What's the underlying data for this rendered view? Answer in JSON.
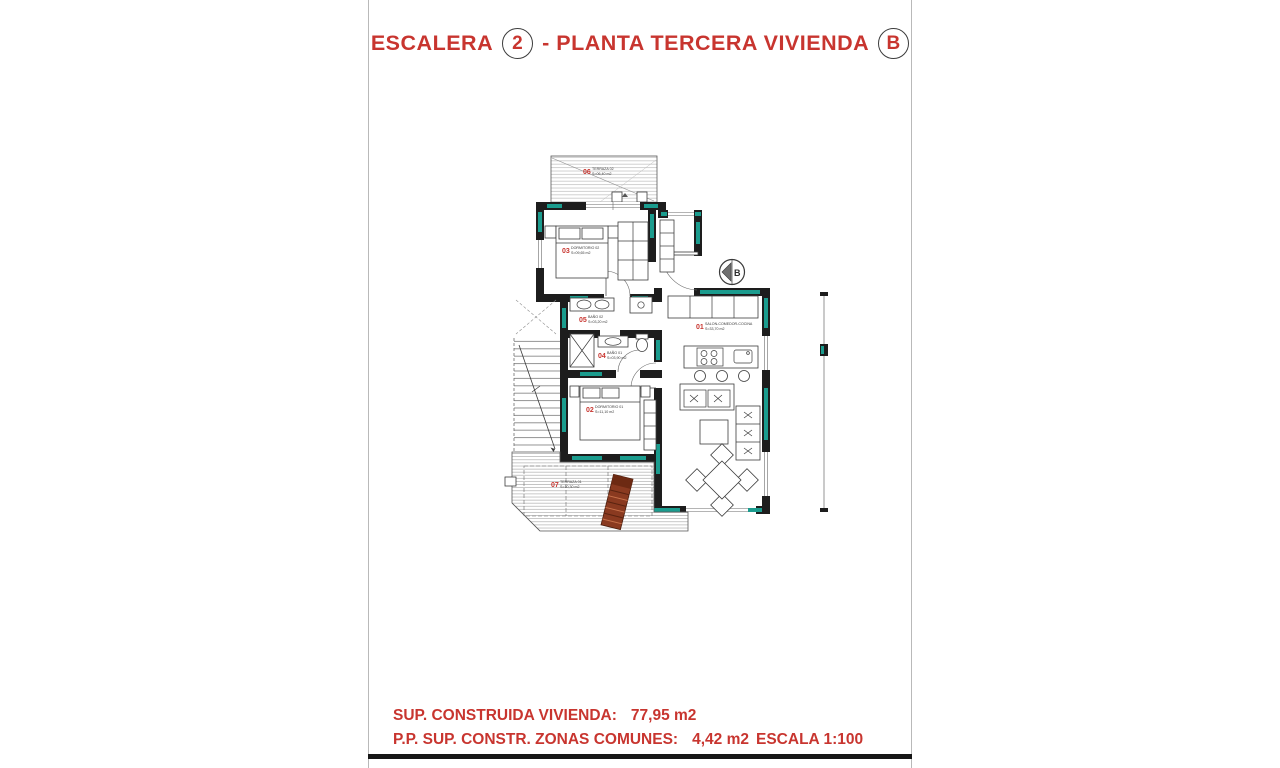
{
  "title": {
    "prefix": "ESCALERA",
    "stair_number": "2",
    "middle": "- PLANTA TERCERA VIVIENDA",
    "unit_letter": "B"
  },
  "plan": {
    "entrance_label": "B",
    "rooms": [
      {
        "num": "01",
        "name": "SALON-COMEDOR-COCINA",
        "area": "S=33,70 m2"
      },
      {
        "num": "02",
        "name": "DORMITORIO 01",
        "area": "S=11,10 m2"
      },
      {
        "num": "03",
        "name": "DORMITORIO 02",
        "area": "S=09,65 m2"
      },
      {
        "num": "04",
        "name": "BAÑO 01",
        "area": "S=03,90 m2"
      },
      {
        "num": "05",
        "name": "BAÑO 02",
        "area": "S=03,20 m2"
      },
      {
        "num": "06",
        "name": "TERRAZA 02",
        "area": "S=06,40 m2"
      },
      {
        "num": "07",
        "name": "TERRAZA 01",
        "area": "S=10,30 m2"
      }
    ]
  },
  "footer": {
    "line1_label": "SUP. CONSTRUIDA VIVIENDA:",
    "line1_value": "77,95 m2",
    "line2_label": "P.P. SUP. CONSTR. ZONAS COMUNES:",
    "line2_value": "4,42 m2",
    "scale": "ESCALA 1:100"
  },
  "colors": {
    "accent_red": "#c8352f",
    "wall_teal": "#1b9c8e",
    "wall_black": "#1d1d1d",
    "chair_brown": "#8a3a20"
  }
}
